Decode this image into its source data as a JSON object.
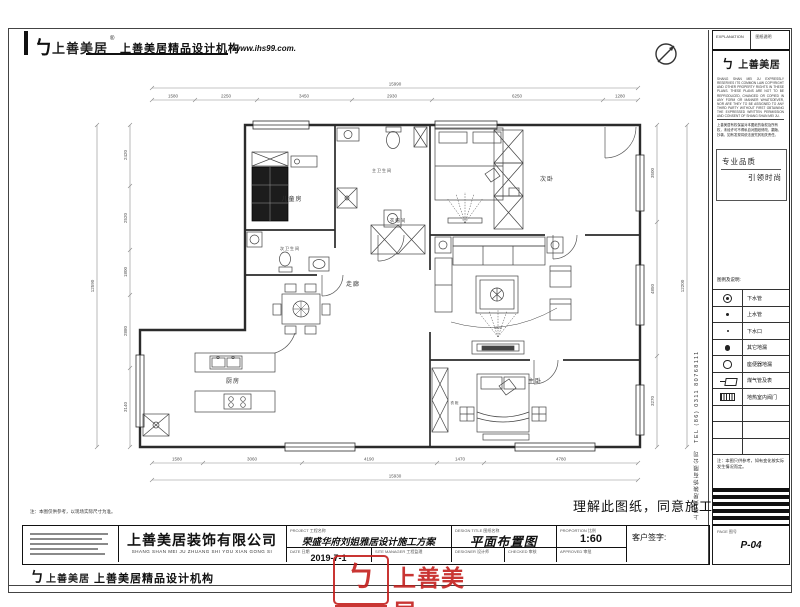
{
  "header": {
    "logo_mark": "ㄅ",
    "logo_name": "上善美居",
    "reg": "®",
    "org": "上善美居精品设计机构",
    "website": "www.ihs99.com."
  },
  "plan": {
    "rooms": {
      "children": "儿童房",
      "bath_main": "主卫生间",
      "bath_second": "次卫生间",
      "bedroom_second": "次卧",
      "corridor": "走廊",
      "cloakroom": "衣帽间",
      "kitchen": "厨房",
      "master": "主卧",
      "wardrobe": "衣柜"
    },
    "dims": {
      "top": {
        "total": "15990",
        "segs": [
          "1580",
          "2250",
          "3450",
          "2930",
          "6250",
          "1280"
        ]
      },
      "bottom": {
        "total": "15930",
        "segs": [
          "1580",
          "3060",
          "4190",
          "1470",
          "4780"
        ]
      },
      "left": {
        "total": "12590",
        "segs": [
          "2420",
          "2520",
          "1800",
          "2880",
          "3140"
        ]
      },
      "right": {
        "total": "12200",
        "segs": [
          "3500",
          "4850",
          "3270"
        ]
      },
      "tv": "1825"
    }
  },
  "sidebar": {
    "col_title_en": "EXPLANATION",
    "col_title_cn": "图纸说明",
    "logo_mark": "ㄅ",
    "logo_name": "上善美居",
    "copyright_en": "SHANG SHAN MEI JU EXPRESSLY RESERVES ITS COMMON LAW COPYRIGHT AND OTHER PROPERTY RIGHTS IN THESE PLANS. THESE PLANS ARE NOT TO BE REPRODUCED, CHANGED OR COPIED IN ANY FORM OR MANNER WHATSOEVER, NOR ARE THEY TO BE ASSIGNED TO ANY THIRD PARTY WITHOUT FIRST OBTAINING THE EXPRESSED WRITTEN PERMISSION AND CONSENT OF SHANG SHAN MEI JU.",
    "copyright_cn": "上善美居有权保留对本图纸的版权及所有权，未经许可不得私自对图纸修改、翻版、抄袭，如有发现将依法追究其相关责任。",
    "slogan_top": "专业品质",
    "slogan_bottom": "引领时尚",
    "legend_title": "图例及说明:",
    "legend": [
      {
        "icon": "drain-pipe-icon",
        "label": "下水管"
      },
      {
        "icon": "water-supply-pipe-icon",
        "label": "上水管"
      },
      {
        "icon": "drain-outlet-icon",
        "label": "下水口"
      },
      {
        "icon": "other-floor-drain-icon",
        "label": "其它地漏"
      },
      {
        "icon": "toilet-floor-drain-icon",
        "label": "座便器地漏"
      },
      {
        "icon": "gas-pipe-meter-icon",
        "label": "煤气管及表"
      },
      {
        "icon": "floor-heating-valve-icon",
        "label": "地热室内阀门"
      }
    ],
    "note": "注：本图只供参考，如有变化按实际发生情况而定。",
    "side_text": "上善美居装饰有限公司　TEL (86) 0311 80768111"
  },
  "titleblock": {
    "company_cn": "上善美居装饰有限公司",
    "company_py": "SHANG SHAN MEI JU ZHUANG SHI YOU XIAN GONG SI",
    "project_label": "PROJECT 工程名称",
    "project_value": "荣盛华府刘姐雅居设计施工方案",
    "date_label": "DATE 日期",
    "date_value": "2019-7-1",
    "manager_label": "SITE MANAGER 工程监理",
    "title_label": "DESIGN TITLE 图纸名称",
    "title_value": "平面布置图",
    "designer_label": "DESIGNER 设计师",
    "checker_label": "CHECKED 审核",
    "scale_label": "PROPORTION 比例",
    "scale_value": "1:60",
    "approved_label": "APPROVED 审批",
    "customer_label": "客户签字:",
    "page_label": "PAGE 图号",
    "page_value": "P-04"
  },
  "footer": {
    "logo_mark": "ㄅ",
    "logo_name": "上善美居",
    "org": "上善美居精品设计机构"
  },
  "notes": {
    "approval": "理解此图纸，同意施工",
    "bottom": "注：本图仅供参考，以现场实际尺寸为准。"
  },
  "stamp": {
    "mark": "ㄅ",
    "name": "上善美居"
  }
}
